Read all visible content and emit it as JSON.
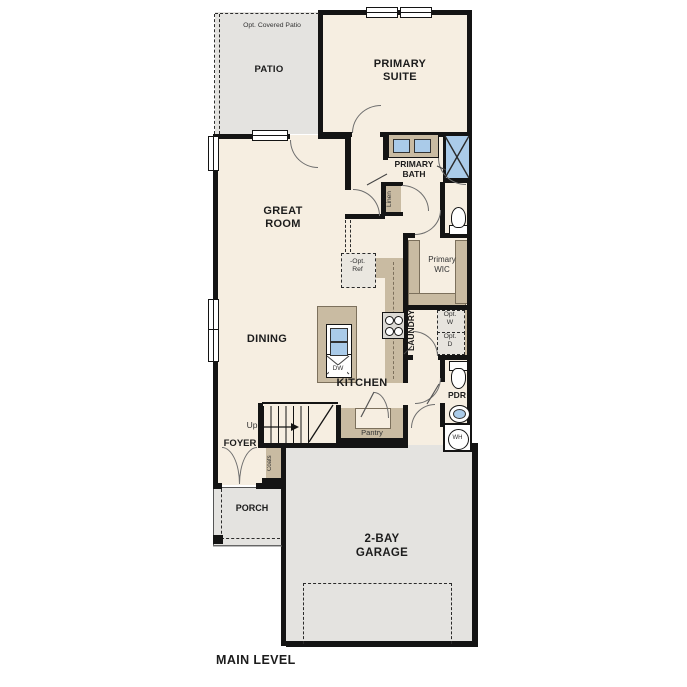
{
  "plan": {
    "title": "MAIN LEVEL",
    "colors": {
      "floor_cream": "#f6eee1",
      "hardscape_gray": "#e4e3e0",
      "casework_tan": "#c9bba2",
      "fixture_blue": "#aacbe9",
      "wall_black": "#141414"
    }
  },
  "labels": {
    "opt_covered_patio": "Opt. Covered Patio",
    "patio": "PATIO",
    "primary_suite": "PRIMARY\nSUITE",
    "primary_bath": "PRIMARY\nBATH",
    "linen": "Linen",
    "primary_wic": "Primary\nWIC",
    "opt_ref": "-Opt.\nRef",
    "great_room": "GREAT\nROOM",
    "dining": "DINING",
    "kitchen": "KITCHEN",
    "dw": "DW",
    "laundry": "LAUNDRY",
    "opt_w": "Opt.\nW",
    "opt_d": "Opt.\nD",
    "pdr": "PDR",
    "wh": "WH",
    "up": "Up",
    "pantry": "Pantry",
    "foyer": "FOYER",
    "coats": "Coats",
    "porch": "PORCH",
    "garage": "2-BAY\nGARAGE",
    "main_level": "MAIN LEVEL"
  }
}
